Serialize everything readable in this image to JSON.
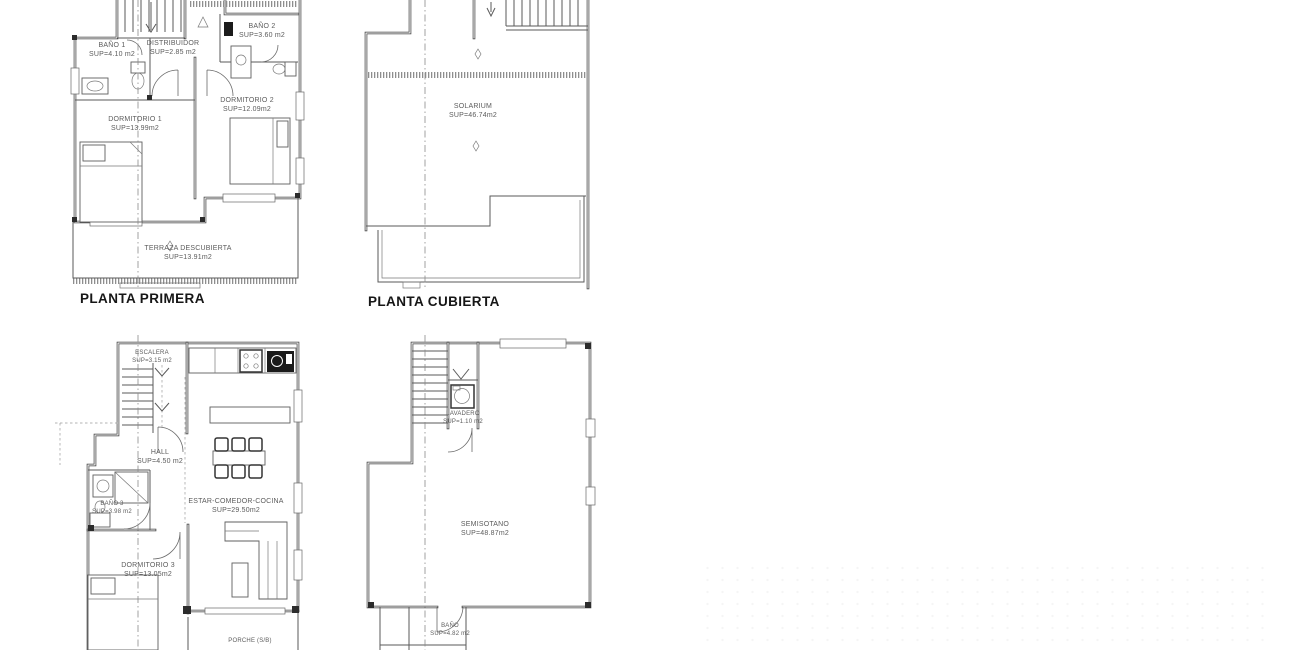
{
  "drawing": {
    "titles": {
      "planta_primera": "PLANTA PRIMERA",
      "planta_cubierta": "PLANTA CUBIERTA"
    },
    "plans": {
      "primera": {
        "rooms": {
          "bano1": {
            "name": "BAÑO 1",
            "sup": "SUP=4.10 m2"
          },
          "distribuidor": {
            "name": "DISTRIBUIDOR",
            "sup": "SUP=2.85 m2"
          },
          "bano2": {
            "name": "BAÑO 2",
            "sup": "SUP=3.60 m2"
          },
          "dormitorio1": {
            "name": "DORMITORIO 1",
            "sup": "SUP=13.99m2"
          },
          "dormitorio2": {
            "name": "DORMITORIO 2",
            "sup": "SUP=12.09m2"
          },
          "terraza": {
            "name": "TERRAZA DESCUBIERTA",
            "sup": "SUP=13.91m2"
          }
        }
      },
      "cubierta": {
        "rooms": {
          "solarium": {
            "name": "SOLARIUM",
            "sup": "SUP=46.74m2"
          }
        }
      },
      "baja": {
        "rooms": {
          "escalera": {
            "name": "ESCALERA",
            "sup": "SUP=3.15 m2"
          },
          "hall": {
            "name": "HALL",
            "sup": "SUP=4.50 m2"
          },
          "bano3": {
            "name": "BAÑO 3",
            "sup": "SUP=3.98 m2"
          },
          "dormitorio3": {
            "name": "DORMITORIO 3",
            "sup": "SUP=13.05m2"
          },
          "estar": {
            "name": "ESTAR-COMEDOR-COCINA",
            "sup": "SUP=29.50m2"
          },
          "porche": {
            "name": "PORCHE (S/B)",
            "sup": ""
          }
        }
      },
      "semisotano": {
        "rooms": {
          "lavadero": {
            "name": "LAVADERO",
            "sup": "SUP=1.10 m2"
          },
          "semisotano": {
            "name": "SEMISOTANO",
            "sup": "SUP=48.87m2"
          },
          "bano": {
            "name": "BAÑO",
            "sup": "SUP=4.82 m2"
          }
        }
      }
    }
  }
}
